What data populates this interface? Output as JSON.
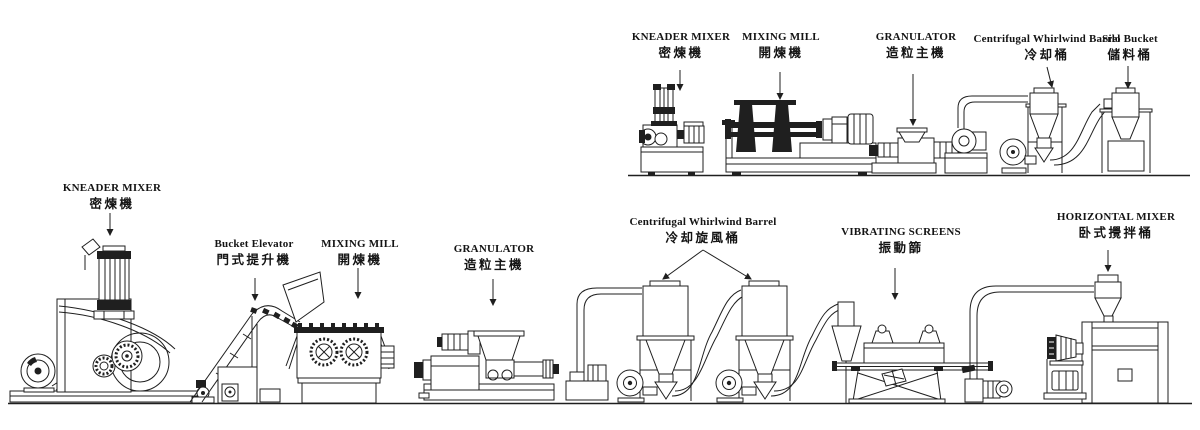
{
  "diagram": {
    "type": "equipment-process-flow-line-drawing",
    "description": "Two rubber/plastic compounding production lines drawn as black-and-white engineering elevations",
    "colors": {
      "background": "#ffffff",
      "line": "#1f1f1f",
      "text": "#141414"
    }
  },
  "labels": {
    "top": [
      {
        "en": "KNEADER MIXER",
        "zh": "密煉機"
      },
      {
        "en": "MIXING MILL",
        "zh": "開煉機"
      },
      {
        "en": "GRANULATOR",
        "zh": "造粒主機"
      },
      {
        "en": "Centrifugal Whirlwind Barrel",
        "zh": "冷却桶"
      },
      {
        "en": "Silo Bucket",
        "zh": "儲料桶"
      }
    ],
    "bottom": [
      {
        "en": "KNEADER MIXER",
        "zh": "密煉機"
      },
      {
        "en": "Bucket Elevator",
        "zh": "門式提升機"
      },
      {
        "en": "MIXING MILL",
        "zh": "開煉機"
      },
      {
        "en": "GRANULATOR",
        "zh": "造粒主機"
      },
      {
        "en": "Centrifugal Whirlwind Barrel",
        "zh": "冷却旋風桶"
      },
      {
        "en": "VIBRATING SCREENS",
        "zh": "振動篩"
      },
      {
        "en": "HORIZONTAL MIXER",
        "zh": "卧式攪拌桶"
      }
    ]
  }
}
